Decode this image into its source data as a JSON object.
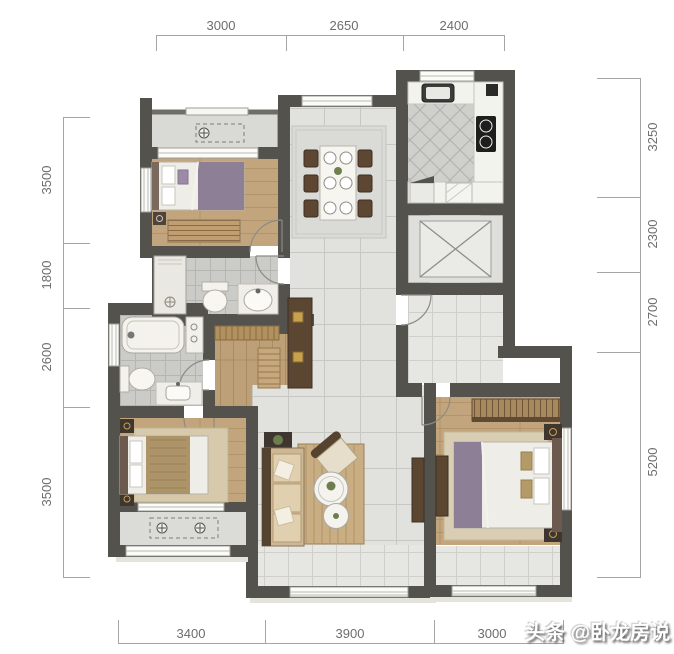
{
  "plan": {
    "type": "apartment-floor-plan",
    "rooms": [
      "balcony-top",
      "bedroom-secondary",
      "dining",
      "kitchen",
      "elevator-shaft",
      "foyer",
      "bathroom-main",
      "bathroom-secondary",
      "hallway",
      "bedroom-small",
      "balcony-small",
      "living",
      "balcony-living",
      "bedroom-master",
      "window-bay-master"
    ]
  },
  "dimensions": {
    "top": [
      "3000",
      "2650",
      "2400"
    ],
    "bottom": [
      "3400",
      "3900",
      "3000"
    ],
    "left": [
      "3500",
      "1800",
      "2600",
      "3500"
    ],
    "right": [
      "3250",
      "2300",
      "2700",
      "5200"
    ]
  },
  "watermark": {
    "text": "头条 @卧龙房说"
  },
  "colors": {
    "wall": "#54524c",
    "wall_light": "#6e6d68",
    "wood_floor": "#c3a57d",
    "marble_floor": "#e1e2de",
    "tile_gray": "#cbcbc7",
    "balcony_tile": "#e6e6e2",
    "bedding_accent": "#8d7f95",
    "furniture_dark": "#5a4631",
    "dim_text": "#6d6d6d",
    "watermark_text": "#ffffff"
  }
}
